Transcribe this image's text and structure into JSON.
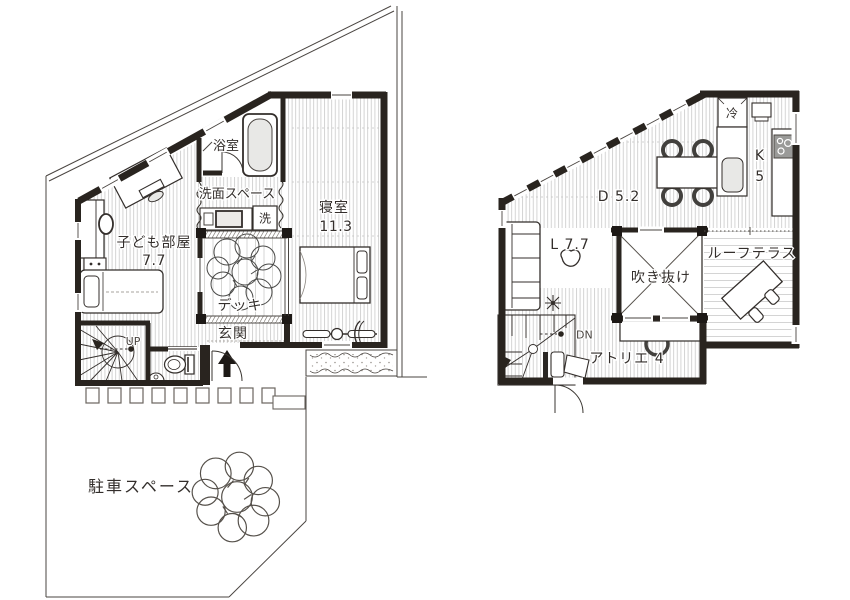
{
  "plan": {
    "floor1": {
      "bath": "浴室",
      "washroom": "洗面スペース",
      "washer": "洗",
      "bedroom": {
        "name": "寝室",
        "area": "11.3"
      },
      "kids_room": {
        "name": "子ども部屋",
        "area": "7.7"
      },
      "deck": "デッキ",
      "entrance": "玄関",
      "stairs_up": "UP",
      "parking": "駐車スペース"
    },
    "floor2": {
      "dining": "D 5.2",
      "kitchen": {
        "name": "K",
        "area": "5"
      },
      "fridge": "冷",
      "living": "L 7.7",
      "void": "吹き抜け",
      "roof_terrace": "ルーフテラス",
      "atelier": "アトリエ 4",
      "stairs_down": "DN"
    },
    "colors": {
      "wall": "#29241f",
      "floor_stripe": "#cfcfcf",
      "fixture_fill": "#e8e8e6",
      "cooktop": "#9a9a98",
      "text": "#332e2b"
    }
  }
}
